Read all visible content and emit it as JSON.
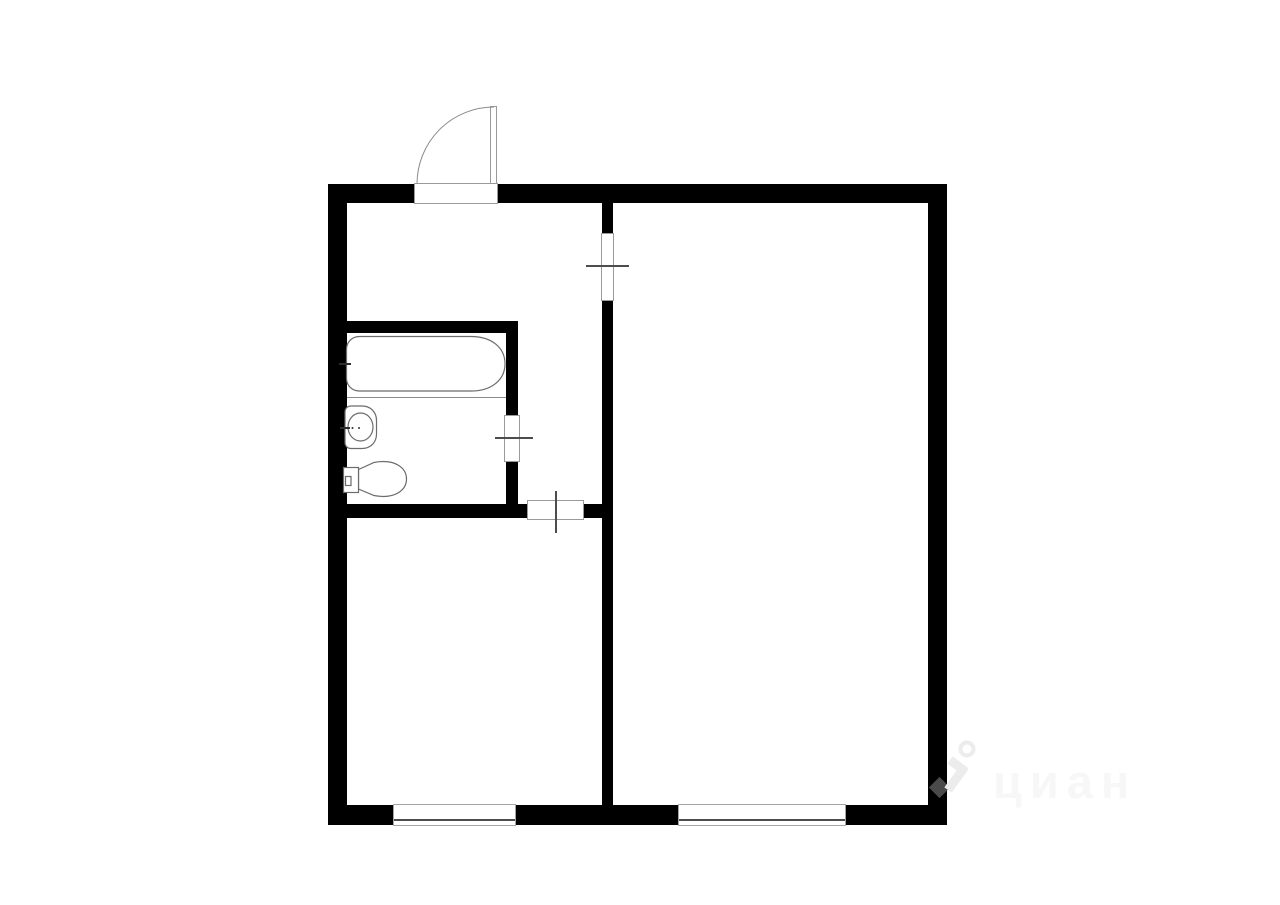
{
  "canvas": {
    "width": 1280,
    "height": 905,
    "background": "#ffffff"
  },
  "palette": {
    "wall": "#000000",
    "fixtureOutline": "#6b6b6b",
    "doorFrame": "#9a9a9a",
    "doorSwing": "#8a8a8a",
    "marker": "#4d4d4d",
    "windowLine": "#4d4d4d",
    "divider": "#8a8a8a",
    "watermarkText": "#f7f7f7",
    "watermarkIcon": "#ececec",
    "watermarkIconOnWall": "#4a4a4a"
  },
  "watermark": {
    "text": "циан",
    "icon": "cian-person-pin-icon"
  },
  "floorplan": {
    "type": "floor-plan",
    "description": "One-room apartment plan: hallway and corridor at top left, bathroom with tub/sink/toilet at left, kitchen at bottom left, large living room at right; entrance door at top, two windows at bottom",
    "fixtures": [
      "bathtub",
      "sink",
      "toilet"
    ],
    "elements": [
      {
        "name": "outer-wall-left",
        "type": "wall",
        "x": 328,
        "y": 184,
        "w": 19,
        "h": 641
      },
      {
        "name": "outer-wall-right",
        "type": "wall",
        "x": 928,
        "y": 184,
        "w": 19,
        "h": 641
      },
      {
        "name": "outer-wall-top-left-of-entrance",
        "type": "wall",
        "x": 328,
        "y": 184,
        "w": 87,
        "h": 19
      },
      {
        "name": "outer-wall-top-right-of-entrance",
        "type": "wall",
        "x": 498,
        "y": 184,
        "w": 449,
        "h": 19
      },
      {
        "name": "outer-wall-bottom-left",
        "type": "wall",
        "x": 328,
        "y": 805,
        "w": 66,
        "h": 20
      },
      {
        "name": "outer-wall-bottom-middle",
        "type": "wall",
        "x": 516,
        "y": 805,
        "w": 163,
        "h": 20
      },
      {
        "name": "outer-wall-bottom-right",
        "type": "wall",
        "x": 846,
        "y": 805,
        "w": 101,
        "h": 20
      },
      {
        "name": "inner-wall-vertical-above-door",
        "type": "wall",
        "x": 602,
        "y": 203,
        "w": 11,
        "h": 30
      },
      {
        "name": "inner-wall-vertical-below-door",
        "type": "wall",
        "x": 602,
        "y": 301,
        "w": 11,
        "h": 504
      },
      {
        "name": "bathroom-wall-top",
        "type": "wall",
        "x": 347,
        "y": 321,
        "w": 171,
        "h": 12
      },
      {
        "name": "bathroom-wall-right-upper",
        "type": "wall",
        "x": 506,
        "y": 321,
        "w": 12,
        "h": 95
      },
      {
        "name": "bathroom-wall-right-lower",
        "type": "wall",
        "x": 506,
        "y": 462,
        "w": 12,
        "h": 42
      },
      {
        "name": "bathroom-wall-bottom",
        "type": "wall",
        "x": 347,
        "y": 504,
        "w": 181,
        "h": 14
      },
      {
        "name": "corridor-wall-bottom-stub",
        "type": "wall",
        "x": 583,
        "y": 504,
        "w": 19,
        "h": 14
      },
      {
        "name": "kitchen-window",
        "type": "window",
        "x": 393,
        "y": 804,
        "w": 123,
        "h": 22
      },
      {
        "name": "living-room-window",
        "type": "window",
        "x": 678,
        "y": 804,
        "w": 168,
        "h": 22
      },
      {
        "name": "entrance-door-opening",
        "type": "door",
        "x": 414,
        "y": 183,
        "w": 84,
        "h": 21
      },
      {
        "name": "entrance-door-leaf",
        "type": "door",
        "x": 490,
        "y": 106,
        "w": 7,
        "h": 78
      },
      {
        "name": "living-room-door-opening",
        "type": "door",
        "x": 601,
        "y": 233,
        "w": 13,
        "h": 68
      },
      {
        "name": "bathroom-door-opening",
        "type": "door",
        "x": 504,
        "y": 415,
        "w": 16,
        "h": 47
      },
      {
        "name": "kitchen-door-opening",
        "type": "door",
        "x": 527,
        "y": 500,
        "w": 57,
        "h": 20
      },
      {
        "name": "living-room-door-marker",
        "type": "marker",
        "x": 586,
        "y": 265,
        "w": 43,
        "h": 2
      },
      {
        "name": "bathroom-door-marker",
        "type": "marker",
        "x": 495,
        "y": 437,
        "w": 38,
        "h": 2
      },
      {
        "name": "kitchen-door-marker",
        "type": "marker",
        "x": 555,
        "y": 491,
        "w": 2,
        "h": 42
      }
    ]
  }
}
